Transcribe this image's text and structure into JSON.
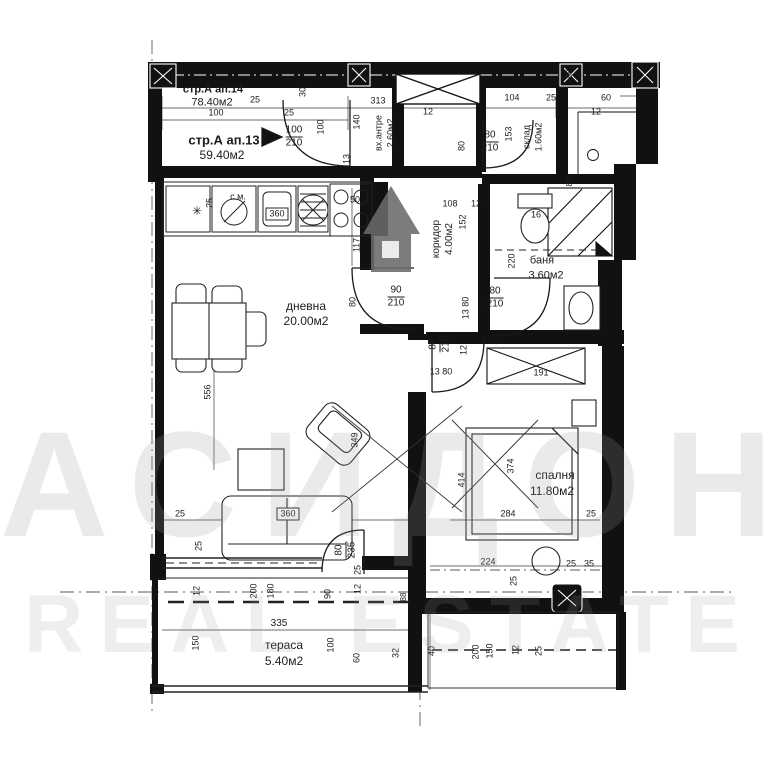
{
  "plan": {
    "apartments": [
      {
        "name": "стр.А ап.14",
        "area": "78.40м2"
      },
      {
        "name": "стр.А ап.13",
        "area": "59.40м2"
      }
    ],
    "rooms": [
      {
        "name": "дневна",
        "area": "20.00м2"
      },
      {
        "name": "спалня",
        "area": "11.80м2"
      },
      {
        "name": "баня",
        "area": "3.60м2"
      },
      {
        "name": "коридор",
        "area": "4.00м2"
      },
      {
        "name": "вх.антре",
        "area": "2.60м2"
      },
      {
        "name": "склад",
        "area": "1.60м2"
      },
      {
        "name": "тераса",
        "area": "5.40м2"
      }
    ],
    "door_sizes": [
      "100/210",
      "80/210",
      "90/210",
      "80/210",
      "80/210",
      "80/235"
    ],
    "furniture_tags": [
      "с.м.",
      "360",
      "360",
      "50",
      "16"
    ],
    "watermark": {
      "line1": "АСИДОНА",
      "line2": "REAL ESTATE"
    },
    "colors": {
      "ink": "#1c1c1c",
      "watermark": "#9b9b9b",
      "logo": "#6a6a6a"
    },
    "labels": [
      {
        "t": "стр.А ап.14",
        "x": 213,
        "y": 90,
        "s": 11,
        "b": 1,
        "n": "apartment-14-label"
      },
      {
        "t": "78.40м2",
        "x": 212,
        "y": 103,
        "s": 11,
        "n": "apartment-14-area"
      },
      {
        "t": "25",
        "x": 255,
        "y": 100,
        "s": 9
      },
      {
        "t": "100",
        "x": 216,
        "y": 113,
        "s": 9
      },
      {
        "t": "25",
        "x": 289,
        "y": 113,
        "s": 9
      },
      {
        "t": "стр.А ап.13",
        "x": 224,
        "y": 140,
        "s": 13,
        "b": 1,
        "n": "apartment-13-label"
      },
      {
        "t": "59.40м2",
        "x": 222,
        "y": 155,
        "s": 12,
        "n": "apartment-13-area"
      },
      {
        "t": "30",
        "x": 303,
        "y": 92,
        "s": 9,
        "r": 1
      },
      {
        "t": "100",
        "x": 321,
        "y": 127,
        "s": 9,
        "r": 1
      },
      {
        "t": "313",
        "x": 378,
        "y": 101,
        "s": 9
      },
      {
        "t": "140",
        "x": 357,
        "y": 122,
        "s": 9,
        "r": 1
      },
      {
        "t": "вх.антре",
        "x": 379,
        "y": 133,
        "s": 9,
        "r": 1,
        "n": "room-entry-hall-label"
      },
      {
        "t": "2.60м2",
        "x": 391,
        "y": 133,
        "s": 9,
        "r": 1,
        "n": "room-entry-hall-area"
      },
      {
        "t": "13",
        "x": 347,
        "y": 159,
        "s": 9,
        "r": 1
      },
      {
        "f": [
          "100",
          "210"
        ],
        "x": 294,
        "y": 137,
        "s": 10,
        "n": "door-size-label"
      },
      {
        "t": "104",
        "x": 512,
        "y": 98,
        "s": 9
      },
      {
        "t": "25",
        "x": 551,
        "y": 98,
        "s": 9
      },
      {
        "t": "60",
        "x": 606,
        "y": 98,
        "s": 9
      },
      {
        "t": "12",
        "x": 596,
        "y": 112,
        "s": 9
      },
      {
        "t": "12",
        "x": 428,
        "y": 112,
        "s": 9
      },
      {
        "t": "80",
        "x": 462,
        "y": 146,
        "s": 9,
        "r": 1
      },
      {
        "f": [
          "80",
          "210"
        ],
        "x": 490,
        "y": 142,
        "s": 10,
        "n": "door-size-label"
      },
      {
        "t": "153",
        "x": 509,
        "y": 134,
        "s": 9,
        "r": 1
      },
      {
        "t": "склад",
        "x": 527,
        "y": 137,
        "s": 9,
        "r": 1,
        "n": "room-storage-label"
      },
      {
        "t": "1.60м2",
        "x": 539,
        "y": 137,
        "s": 9,
        "r": 1,
        "n": "room-storage-area"
      },
      {
        "t": "88",
        "x": 570,
        "y": 74,
        "s": 8,
        "r": 1
      },
      {
        "t": "88",
        "x": 570,
        "y": 182,
        "s": 8,
        "r": 1
      },
      {
        "t": "с.м.",
        "x": 238,
        "y": 197,
        "s": 9,
        "n": "washing-machine-tag"
      },
      {
        "t": "25",
        "x": 210,
        "y": 203,
        "s": 9,
        "r": 1
      },
      {
        "t": "360",
        "x": 277,
        "y": 214,
        "s": 9,
        "box": 1,
        "n": "kitchen-sink-tag"
      },
      {
        "t": "50",
        "x": 355,
        "y": 200,
        "s": 9
      },
      {
        "t": "117",
        "x": 357,
        "y": 245,
        "s": 9,
        "r": 1
      },
      {
        "t": "108",
        "x": 450,
        "y": 204,
        "s": 9
      },
      {
        "t": "12",
        "x": 476,
        "y": 204,
        "s": 9
      },
      {
        "t": "16",
        "x": 536,
        "y": 215,
        "s": 9,
        "n": "toilet-tag"
      },
      {
        "t": "коридор",
        "x": 437,
        "y": 239,
        "s": 10,
        "r": 1,
        "n": "room-corridor-label"
      },
      {
        "t": "4.00м2",
        "x": 450,
        "y": 239,
        "s": 10,
        "r": 1,
        "n": "room-corridor-area"
      },
      {
        "t": "152",
        "x": 463,
        "y": 222,
        "s": 9,
        "r": 1
      },
      {
        "t": "220",
        "x": 512,
        "y": 261,
        "s": 9,
        "r": 1
      },
      {
        "t": "баня",
        "x": 542,
        "y": 261,
        "s": 11,
        "n": "room-bathroom-label"
      },
      {
        "t": "3.60м2",
        "x": 546,
        "y": 276,
        "s": 11,
        "n": "room-bathroom-area"
      },
      {
        "f": [
          "80",
          "210"
        ],
        "x": 495,
        "y": 298,
        "s": 10,
        "n": "door-size-label"
      },
      {
        "t": "13 80",
        "x": 466,
        "y": 308,
        "s": 9,
        "r": 1
      },
      {
        "f": [
          "90",
          "210"
        ],
        "x": 396,
        "y": 297,
        "s": 10,
        "n": "door-size-label"
      },
      {
        "t": "80",
        "x": 353,
        "y": 302,
        "s": 9,
        "r": 1
      },
      {
        "t": "дневна",
        "x": 306,
        "y": 306,
        "s": 12,
        "n": "room-living-label"
      },
      {
        "t": "20.00м2",
        "x": 306,
        "y": 321,
        "s": 12,
        "n": "room-living-area"
      },
      {
        "f": [
          "80",
          "210"
        ],
        "x": 440,
        "y": 344,
        "s": 10,
        "r": 1,
        "n": "door-size-label"
      },
      {
        "t": "12",
        "x": 464,
        "y": 350,
        "s": 9,
        "r": 1
      },
      {
        "t": "13  80",
        "x": 441,
        "y": 372,
        "s": 9
      },
      {
        "t": "191",
        "x": 541,
        "y": 373,
        "s": 9
      },
      {
        "t": "349",
        "x": 355,
        "y": 440,
        "s": 9,
        "r": 1
      },
      {
        "t": "556",
        "x": 208,
        "y": 392,
        "s": 9,
        "r": 1
      },
      {
        "t": "374",
        "x": 511,
        "y": 466,
        "s": 9,
        "r": 1
      },
      {
        "t": "414",
        "x": 462,
        "y": 480,
        "s": 9,
        "r": 1
      },
      {
        "t": "спалня",
        "x": 555,
        "y": 475,
        "s": 12,
        "n": "room-bedroom-label"
      },
      {
        "t": "11.80м2",
        "x": 552,
        "y": 491,
        "s": 12,
        "n": "room-bedroom-area"
      },
      {
        "t": "284",
        "x": 508,
        "y": 514,
        "s": 9
      },
      {
        "t": "25",
        "x": 591,
        "y": 514,
        "s": 9
      },
      {
        "t": "25",
        "x": 180,
        "y": 514,
        "s": 9
      },
      {
        "t": "360",
        "x": 288,
        "y": 514,
        "s": 9,
        "box": 1,
        "n": "sofa-tag"
      },
      {
        "t": "25",
        "x": 199,
        "y": 546,
        "s": 9,
        "r": 1
      },
      {
        "f": [
          "80",
          "235"
        ],
        "x": 346,
        "y": 550,
        "s": 10,
        "r": 1,
        "n": "door-size-label"
      },
      {
        "t": "25",
        "x": 358,
        "y": 570,
        "s": 9,
        "r": 1
      },
      {
        "t": "12",
        "x": 358,
        "y": 589,
        "s": 9,
        "r": 1
      },
      {
        "t": "200",
        "x": 254,
        "y": 591,
        "s": 9,
        "r": 1
      },
      {
        "t": "180",
        "x": 271,
        "y": 591,
        "s": 9,
        "r": 1
      },
      {
        "t": "90",
        "x": 328,
        "y": 594,
        "s": 9,
        "r": 1
      },
      {
        "t": "12",
        "x": 197,
        "y": 591,
        "s": 9,
        "r": 1
      },
      {
        "t": "88",
        "x": 404,
        "y": 597,
        "s": 8,
        "r": 1
      },
      {
        "t": "335",
        "x": 279,
        "y": 624,
        "s": 10
      },
      {
        "t": "150",
        "x": 196,
        "y": 643,
        "s": 9,
        "r": 1
      },
      {
        "t": "тераса",
        "x": 284,
        "y": 645,
        "s": 12,
        "n": "room-terrace-label"
      },
      {
        "t": "5.40м2",
        "x": 284,
        "y": 661,
        "s": 12,
        "n": "room-terrace-area"
      },
      {
        "t": "100",
        "x": 331,
        "y": 645,
        "s": 9,
        "r": 1
      },
      {
        "t": "60",
        "x": 357,
        "y": 658,
        "s": 9,
        "r": 1
      },
      {
        "t": "32",
        "x": 396,
        "y": 653,
        "s": 9,
        "r": 1
      },
      {
        "t": "40",
        "x": 432,
        "y": 651,
        "s": 9,
        "r": 1
      },
      {
        "t": "224",
        "x": 488,
        "y": 562,
        "s": 9
      },
      {
        "t": "25",
        "x": 514,
        "y": 581,
        "s": 9,
        "r": 1
      },
      {
        "t": "25",
        "x": 571,
        "y": 564,
        "s": 9
      },
      {
        "t": "35",
        "x": 589,
        "y": 564,
        "s": 9
      },
      {
        "t": "200",
        "x": 476,
        "y": 652,
        "s": 9,
        "r": 1
      },
      {
        "t": "150",
        "x": 490,
        "y": 651,
        "s": 9,
        "r": 1
      },
      {
        "t": "12",
        "x": 516,
        "y": 650,
        "s": 9,
        "r": 1
      },
      {
        "t": "25",
        "x": 539,
        "y": 651,
        "s": 9,
        "r": 1
      },
      {
        "t": "✳",
        "x": 197,
        "y": 211,
        "s": 12,
        "n": "fridge-snowflake-icon"
      }
    ]
  }
}
